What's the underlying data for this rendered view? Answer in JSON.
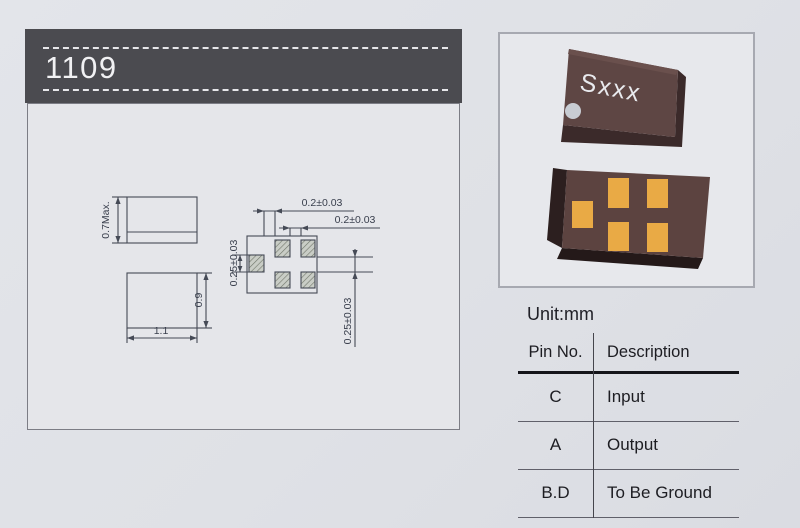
{
  "header": {
    "title": "1109"
  },
  "drawing": {
    "side_view": {
      "height_label": "0.7Max."
    },
    "top_view": {
      "width_label": "1.1",
      "height_label": "0.9"
    },
    "land_pattern": {
      "dim_gap_left_pad": "0.2±0.03",
      "dim_gap_columns": "0.2±0.03",
      "dim_pad_height": "0.25±0.03",
      "dim_row_gap": "0.25±0.03"
    }
  },
  "photos": {
    "chip_marking": "Sxxx"
  },
  "pin_table": {
    "unit_label": "Unit:mm",
    "headers": [
      "Pin No.",
      "Description"
    ],
    "rows": [
      {
        "pin": "C",
        "description": "Input"
      },
      {
        "pin": "A",
        "description": "Output"
      },
      {
        "pin": "B.D",
        "description": "To Be Ground"
      }
    ]
  },
  "colors": {
    "header_bar": "#4b4b50",
    "page_background": "#dfe1e6",
    "drawing_line": "#454a56",
    "chip_body": "#5c4340",
    "pad_gold": "#e9aa45"
  }
}
